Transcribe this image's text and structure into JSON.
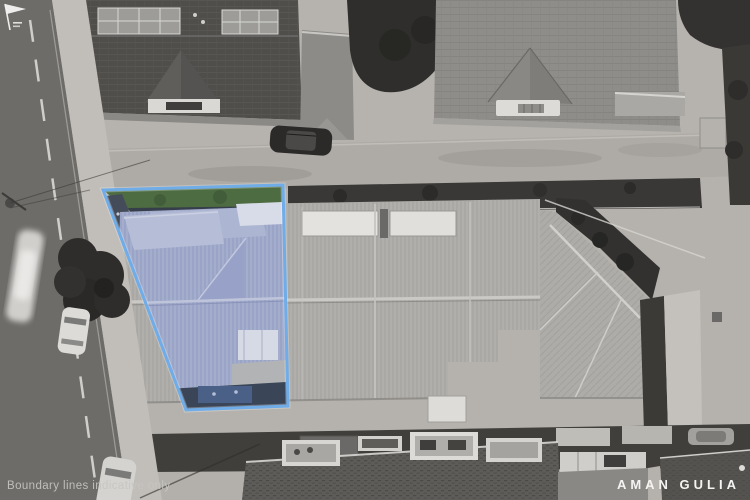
{
  "watermarks": {
    "disclaimer": "Boundary lines indicative only",
    "brand": "AMAN GULIA"
  },
  "boundary": {
    "stroke_color": "#6FACE8",
    "tint_color": "#7FA8E0"
  },
  "icons": {
    "brand_logo": "flag-icon"
  }
}
